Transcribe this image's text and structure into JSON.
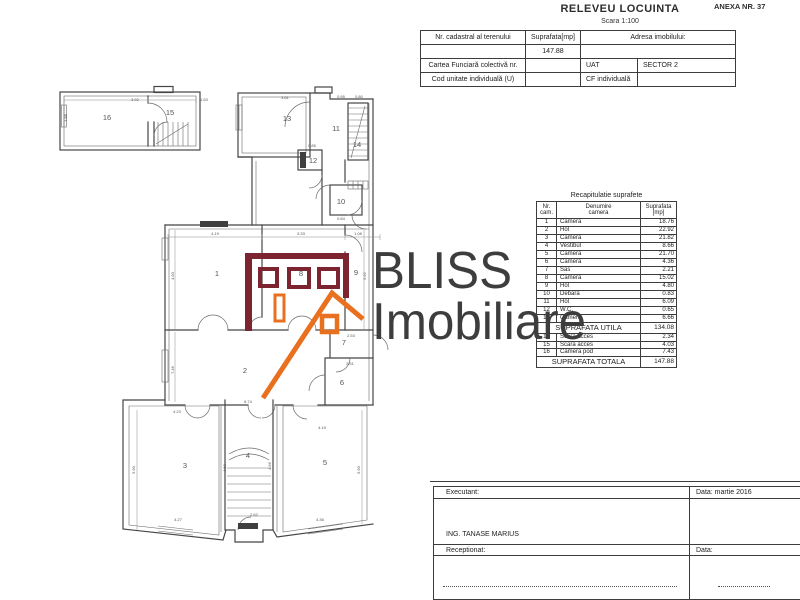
{
  "header": {
    "title": "RELEVEU LOCUINTA",
    "scale": "Scara 1:100",
    "anexa": "ANEXA NR. 37"
  },
  "info_table": {
    "col1_header": "Nr. cadastral al terenului",
    "col2_header": "Suprafata[mp]",
    "col3_header": "Adresa imobilului:",
    "suprafata_value": "147.88",
    "row3_label": "Cartea Funciară colectivă nr.",
    "row3_uat": "UAT",
    "row3_sector": "SECTOR 2",
    "row4_label": "Cod unitate individuală (U)",
    "row4_cf": "CF individuală"
  },
  "recap_table": {
    "title": "Recapitulatie suprafete",
    "headers_top": [
      "Nr.",
      "Denumire",
      "Suprafata"
    ],
    "headers_bot": [
      "cam.",
      "camera",
      "[mp]"
    ],
    "rows": [
      [
        "1",
        "Camera",
        "18.76"
      ],
      [
        "2",
        "Hol",
        "22.92"
      ],
      [
        "3",
        "Camera",
        "21.82"
      ],
      [
        "4",
        "Vestibul",
        "8.66"
      ],
      [
        "5",
        "Camera",
        "21.70"
      ],
      [
        "6",
        "Camera",
        "4.36"
      ],
      [
        "7",
        "Sas",
        "2.21"
      ],
      [
        "8",
        "Camera",
        "15.02"
      ],
      [
        "9",
        "Hol",
        "4.80"
      ],
      [
        "10",
        "Debara",
        "0.83"
      ],
      [
        "11",
        "Hol",
        "6.09"
      ],
      [
        "12",
        "W.C.",
        "0.65"
      ],
      [
        "13",
        "Camera",
        "6.66"
      ]
    ],
    "utila_label": "SUPRAFATA UTILA",
    "utila_value": "134.08",
    "extra_rows": [
      [
        "14",
        "Scara acces",
        "2.34"
      ],
      [
        "15",
        "Scara acces",
        "4.03"
      ],
      [
        "16",
        "Camera pod",
        "7.43"
      ]
    ],
    "totala_label": "SUPRAFATA TOTALA",
    "totala_value": "147.88"
  },
  "title_block": {
    "executant_label": "Executant:",
    "data1": "Data: martie 2016",
    "executant_name": "ING. TANASE MARIUS",
    "receptionat_label": "Receptionat:",
    "data2": "Data:"
  },
  "logo": {
    "line1": "BLISS",
    "line2": "Imobiliare",
    "maroon": "#7c2531",
    "orange": "#e8701f",
    "text_color": "#3d3d3d"
  },
  "floor_plan": {
    "room_labels": [
      {
        "n": "1",
        "x": 187,
        "y": 196
      },
      {
        "n": "2",
        "x": 215,
        "y": 293
      },
      {
        "n": "3",
        "x": 155,
        "y": 388
      },
      {
        "n": "4",
        "x": 218,
        "y": 378
      },
      {
        "n": "5",
        "x": 295,
        "y": 385
      },
      {
        "n": "6",
        "x": 312,
        "y": 305
      },
      {
        "n": "7",
        "x": 314,
        "y": 265
      },
      {
        "n": "8",
        "x": 271,
        "y": 196
      },
      {
        "n": "9",
        "x": 326,
        "y": 195
      },
      {
        "n": "10",
        "x": 311,
        "y": 124
      },
      {
        "n": "11",
        "x": 306,
        "y": 51
      },
      {
        "n": "12",
        "x": 283,
        "y": 83
      },
      {
        "n": "13",
        "x": 257,
        "y": 41
      },
      {
        "n": "14",
        "x": 327,
        "y": 67
      },
      {
        "n": "15",
        "x": 140,
        "y": 35
      },
      {
        "n": "16",
        "x": 77,
        "y": 40
      }
    ],
    "dim_labels": [
      {
        "t": "3.92",
        "x": 105,
        "y": 21,
        "r": 0
      },
      {
        "t": "1.63",
        "x": 174,
        "y": 21,
        "r": 0
      },
      {
        "t": "1.88",
        "x": 37,
        "y": 38,
        "r": -90
      },
      {
        "t": "3.61",
        "x": 255,
        "y": 19,
        "r": 0
      },
      {
        "t": "0.95",
        "x": 311,
        "y": 18,
        "r": 0
      },
      {
        "t": "0.80",
        "x": 329,
        "y": 18,
        "r": 0
      },
      {
        "t": "0.85",
        "x": 282,
        "y": 67,
        "r": 0
      },
      {
        "t": "0.84",
        "x": 311,
        "y": 140,
        "r": 0
      },
      {
        "t": "4.19",
        "x": 185,
        "y": 155,
        "r": 0
      },
      {
        "t": "3.33",
        "x": 271,
        "y": 155,
        "r": 0
      },
      {
        "t": "1.08",
        "x": 328,
        "y": 155,
        "r": 0
      },
      {
        "t": "4.60",
        "x": 144,
        "y": 196,
        "r": -90
      },
      {
        "t": "5.92",
        "x": 336,
        "y": 196,
        "r": -90
      },
      {
        "t": "7.46",
        "x": 144,
        "y": 290,
        "r": -90
      },
      {
        "t": "2.53",
        "x": 321,
        "y": 257,
        "r": 0
      },
      {
        "t": "2.51",
        "x": 320,
        "y": 285,
        "r": 0
      },
      {
        "t": "6.74",
        "x": 218,
        "y": 323,
        "r": 0
      },
      {
        "t": "4.23",
        "x": 147,
        "y": 333,
        "r": 0
      },
      {
        "t": "4.19",
        "x": 292,
        "y": 349,
        "r": 0
      },
      {
        "t": "4.50",
        "x": 196,
        "y": 388,
        "r": -90
      },
      {
        "t": "4.66",
        "x": 241,
        "y": 386,
        "r": -90
      },
      {
        "t": "5.90",
        "x": 105,
        "y": 390,
        "r": -90
      },
      {
        "t": "5.90",
        "x": 330,
        "y": 390,
        "r": -90
      },
      {
        "t": "2.62",
        "x": 224,
        "y": 436,
        "r": 0
      },
      {
        "t": "4.27",
        "x": 148,
        "y": 441,
        "r": 0
      },
      {
        "t": "4.36",
        "x": 290,
        "y": 441,
        "r": 0
      }
    ]
  }
}
